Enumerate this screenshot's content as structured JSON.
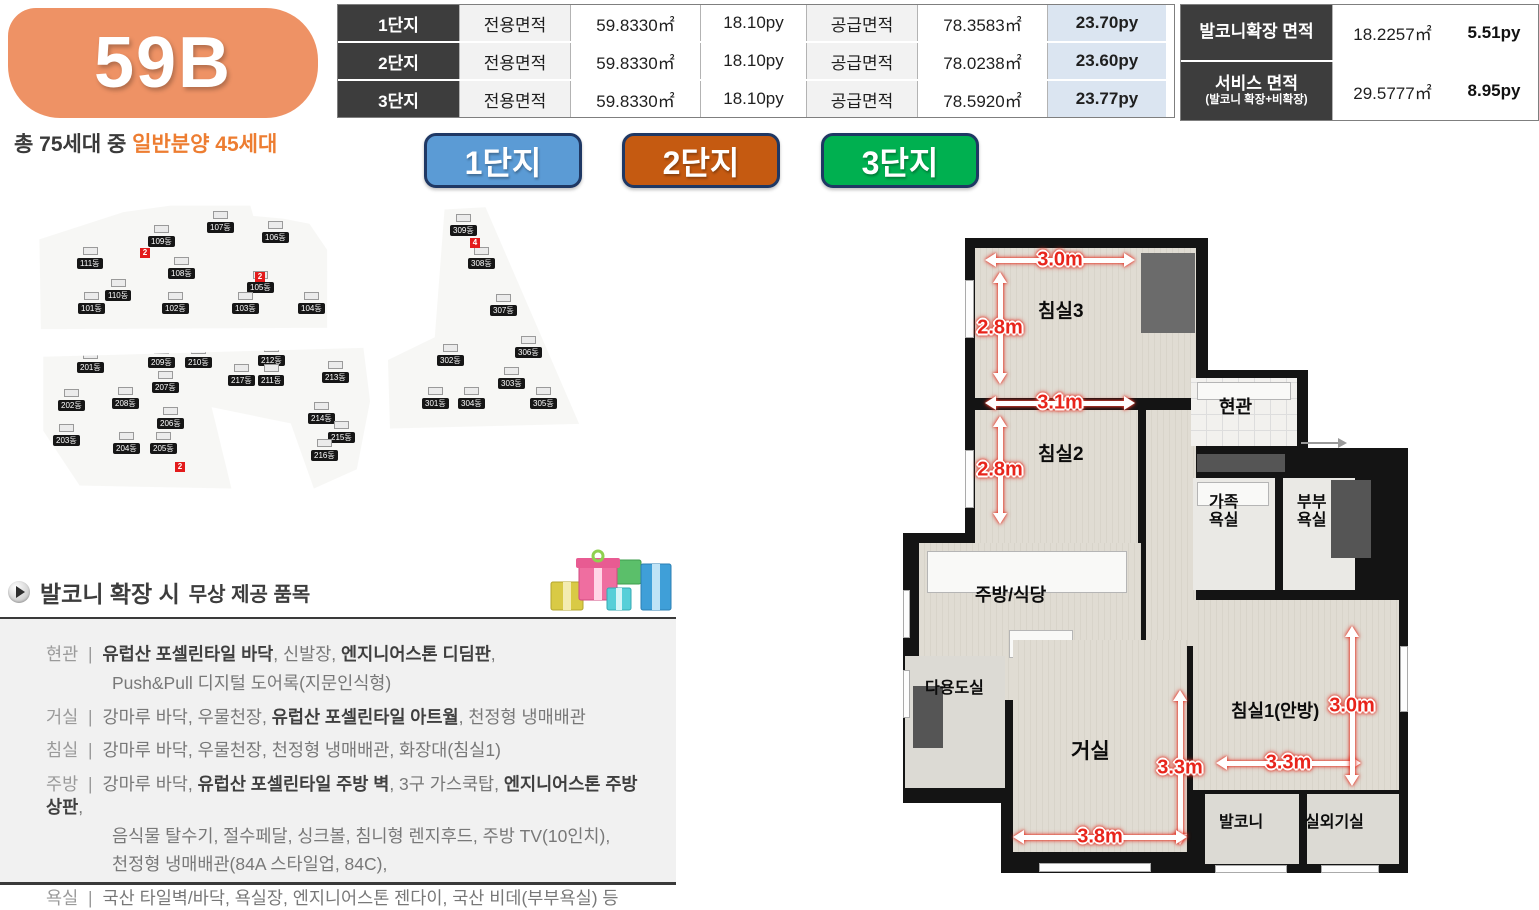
{
  "unit": {
    "code": "59B",
    "badge_color": "#ee9265"
  },
  "household": {
    "prefix": "총 75세대 중 ",
    "highlight": "일반분양 45세대",
    "highlight_color": "#ed7d31"
  },
  "area_table": {
    "rows": [
      {
        "complex": "1단지",
        "exclusive_label": "전용면적",
        "exclusive_m2": "59.8330㎡",
        "exclusive_py": "18.10py",
        "supply_label": "공급면적",
        "supply_m2": "78.3583㎡",
        "supply_py": "23.70py"
      },
      {
        "complex": "2단지",
        "exclusive_label": "전용면적",
        "exclusive_m2": "59.8330㎡",
        "exclusive_py": "18.10py",
        "supply_label": "공급면적",
        "supply_m2": "78.0238㎡",
        "supply_py": "23.60py"
      },
      {
        "complex": "3단지",
        "exclusive_label": "전용면적",
        "exclusive_m2": "59.8330㎡",
        "exclusive_py": "18.10py",
        "supply_label": "공급면적",
        "supply_m2": "78.5920㎡",
        "supply_py": "23.77py"
      }
    ],
    "py_highlight_bg": "#dbe5f1"
  },
  "side_table": {
    "rows": [
      {
        "label": "발코니확장 면적",
        "sub": "",
        "m2": "18.2257㎡",
        "py": "5.51py"
      },
      {
        "label": "서비스 면적",
        "sub": "(발코니 확장+비확장)",
        "m2": "29.5777㎡",
        "py": "8.95py"
      }
    ]
  },
  "complex_buttons": [
    {
      "label": "1단지",
      "color": "#5b9bd5",
      "x": 424
    },
    {
      "label": "2단지",
      "color": "#c55a11",
      "x": 622
    },
    {
      "label": "3단지",
      "color": "#00b050",
      "x": 821
    }
  ],
  "site_maps": [
    {
      "id": "complex-1",
      "frame": {
        "x": 35,
        "y": 203,
        "w": 295,
        "h": 130
      },
      "buildings": [
        {
          "name": "111동",
          "x": 42,
          "y": 55
        },
        {
          "name": "109동",
          "x": 113,
          "y": 33
        },
        {
          "name": "107동",
          "x": 172,
          "y": 19
        },
        {
          "name": "106동",
          "x": 227,
          "y": 29
        },
        {
          "name": "108동",
          "x": 133,
          "y": 65
        },
        {
          "name": "110동",
          "x": 70,
          "y": 87
        },
        {
          "name": "105동",
          "x": 212,
          "y": 79
        },
        {
          "name": "101동",
          "x": 43,
          "y": 100
        },
        {
          "name": "102동",
          "x": 127,
          "y": 100
        },
        {
          "name": "103동",
          "x": 197,
          "y": 100
        },
        {
          "name": "104동",
          "x": 263,
          "y": 100
        }
      ],
      "markers": [
        {
          "n": "2",
          "x": 105,
          "y": 45
        },
        {
          "n": "2",
          "x": 220,
          "y": 69
        }
      ]
    },
    {
      "id": "complex-2",
      "frame": {
        "x": 40,
        "y": 342,
        "w": 330,
        "h": 148
      },
      "buildings": [
        {
          "name": "201동",
          "x": 37,
          "y": 20
        },
        {
          "name": "209동",
          "x": 108,
          "y": 15
        },
        {
          "name": "210동",
          "x": 145,
          "y": 15
        },
        {
          "name": "212동",
          "x": 218,
          "y": 13
        },
        {
          "name": "217동",
          "x": 188,
          "y": 33
        },
        {
          "name": "211동",
          "x": 218,
          "y": 33
        },
        {
          "name": "213동",
          "x": 282,
          "y": 30
        },
        {
          "name": "202동",
          "x": 18,
          "y": 58
        },
        {
          "name": "208동",
          "x": 72,
          "y": 56
        },
        {
          "name": "207동",
          "x": 112,
          "y": 40
        },
        {
          "name": "206동",
          "x": 117,
          "y": 76
        },
        {
          "name": "214동",
          "x": 268,
          "y": 71
        },
        {
          "name": "203동",
          "x": 13,
          "y": 93
        },
        {
          "name": "204동",
          "x": 73,
          "y": 101
        },
        {
          "name": "205동",
          "x": 110,
          "y": 101
        },
        {
          "name": "215동",
          "x": 288,
          "y": 90
        },
        {
          "name": "216동",
          "x": 271,
          "y": 108
        }
      ],
      "markers": [
        {
          "n": "2",
          "x": 135,
          "y": 120
        }
      ]
    },
    {
      "id": "complex-3",
      "frame": {
        "x": 388,
        "y": 205,
        "w": 195,
        "h": 228
      },
      "buildings": [
        {
          "name": "309동",
          "x": 62,
          "y": 20
        },
        {
          "name": "308동",
          "x": 80,
          "y": 53
        },
        {
          "name": "307동",
          "x": 102,
          "y": 100
        },
        {
          "name": "306동",
          "x": 127,
          "y": 142
        },
        {
          "name": "302동",
          "x": 49,
          "y": 150
        },
        {
          "name": "303동",
          "x": 110,
          "y": 173
        },
        {
          "name": "301동",
          "x": 34,
          "y": 193
        },
        {
          "name": "304동",
          "x": 70,
          "y": 193
        },
        {
          "name": "305동",
          "x": 142,
          "y": 193
        }
      ],
      "markers": [
        {
          "n": "4",
          "x": 82,
          "y": 33
        }
      ]
    }
  ],
  "freebies": {
    "title_bold": "발코니 확장 시",
    "title_rest": "무상 제공 품목",
    "separator": "|",
    "items": [
      {
        "label": "현관",
        "lines": [
          [
            {
              "t": "유럽산 포셀린타일 바닥",
              "b": 1
            },
            {
              "t": ", 신발장, "
            },
            {
              "t": "엔지니어스톤 디딤판",
              "b": 1
            },
            {
              "t": ","
            }
          ],
          [
            {
              "t": "Push&Pull 디지털 도어록(지문인식형)"
            }
          ]
        ]
      },
      {
        "label": "거실",
        "lines": [
          [
            {
              "t": "강마루 바닥, 우물천장, "
            },
            {
              "t": "유럽산 포셀린타일 아트월",
              "b": 1
            },
            {
              "t": ", 천정형 냉매배관"
            }
          ]
        ]
      },
      {
        "label": "침실",
        "lines": [
          [
            {
              "t": "강마루 바닥, 우물천장, 천정형 냉매배관, 화장대(침실1)"
            }
          ]
        ]
      },
      {
        "label": "주방",
        "lines": [
          [
            {
              "t": "강마루 바닥, "
            },
            {
              "t": "유럽산 포셀린타일 주방 벽",
              "b": 1
            },
            {
              "t": ", 3구 가스쿡탑, "
            },
            {
              "t": "엔지니어스톤 주방 상판",
              "b": 1
            },
            {
              "t": ","
            }
          ],
          [
            {
              "t": "음식물 탈수기, 절수페달, 싱크볼, 침니형 렌지후드, 주방 TV(10인치),"
            }
          ],
          [
            {
              "t": "천정형 냉매배관(84A 스타일업, 84C),"
            }
          ]
        ]
      },
      {
        "label": "욕실",
        "lines": [
          [
            {
              "t": "국산 타일벽/바닥, 욕실장, 엔지니어스톤 젠다이, 국산 비데(부부욕실) 등"
            }
          ]
        ]
      }
    ]
  },
  "floor_plan": {
    "labels": [
      {
        "text": "침실3",
        "x": 135,
        "y": 64,
        "fs": 19
      },
      {
        "text": "침실2",
        "x": 135,
        "y": 207,
        "fs": 19
      },
      {
        "text": "현관",
        "x": 316,
        "y": 160,
        "fs": 18
      },
      {
        "text": "가족\n욕실",
        "x": 306,
        "y": 256,
        "fs": 16
      },
      {
        "text": "부부\n욕실",
        "x": 394,
        "y": 256,
        "fs": 16
      },
      {
        "text": "주방/식당",
        "x": 72,
        "y": 348,
        "fs": 18
      },
      {
        "text": "다용도실",
        "x": 22,
        "y": 442,
        "fs": 16
      },
      {
        "text": "거실",
        "x": 168,
        "y": 502,
        "fs": 21
      },
      {
        "text": "침실1(안방)",
        "x": 328,
        "y": 464,
        "fs": 18
      },
      {
        "text": "발코니",
        "x": 316,
        "y": 576,
        "fs": 16
      },
      {
        "text": "실외기실",
        "x": 402,
        "y": 576,
        "fs": 16
      }
    ],
    "dimensions": [
      {
        "text": "3.0m",
        "dir": "h",
        "x": 82,
        "y": 15,
        "len": 150
      },
      {
        "text": "2.8m",
        "dir": "v",
        "x": 90,
        "y": 34,
        "len": 112
      },
      {
        "text": "3.1m",
        "dir": "h",
        "x": 82,
        "y": 158,
        "len": 150
      },
      {
        "text": "2.8m",
        "dir": "v",
        "x": 90,
        "y": 178,
        "len": 108
      },
      {
        "text": "3.3m",
        "dir": "v",
        "x": 270,
        "y": 452,
        "len": 155
      },
      {
        "text": "3.3m",
        "dir": "h",
        "x": 313,
        "y": 518,
        "len": 145
      },
      {
        "text": "3.0m",
        "dir": "v",
        "x": 442,
        "y": 388,
        "len": 160
      },
      {
        "text": "3.8m",
        "dir": "h",
        "x": 110,
        "y": 592,
        "len": 174
      }
    ]
  }
}
